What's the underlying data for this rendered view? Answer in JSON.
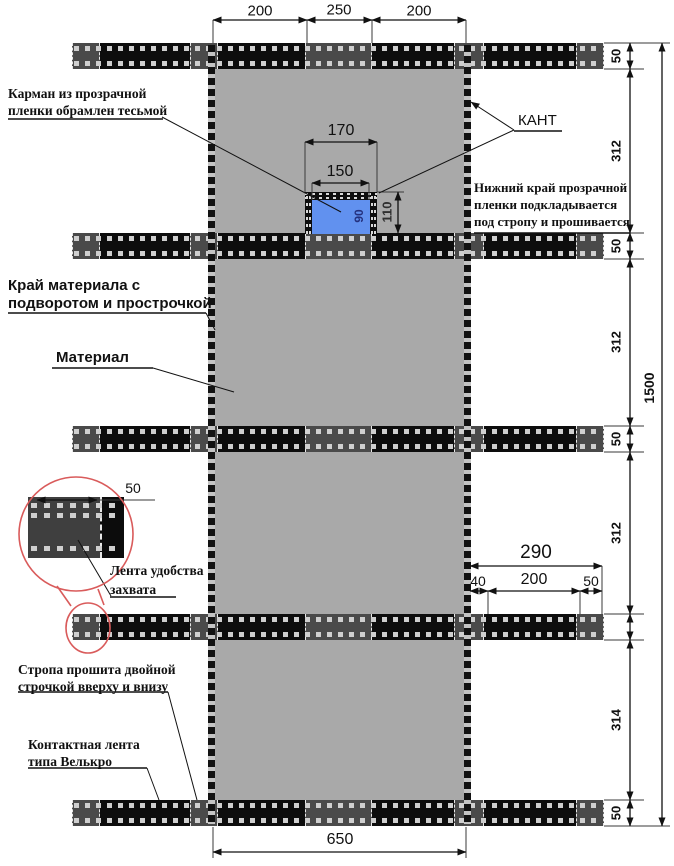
{
  "drawing": {
    "annotations": {
      "pocket": {
        "line1": "Карман из прозрачной",
        "line2": "пленки обрамлен тесьмой"
      },
      "kant": "КАНТ",
      "film_edge": {
        "line1": "Нижний край прозрачной",
        "line2": "пленки подкладывается",
        "line3": "под стропу и прошивается"
      },
      "material_edge": {
        "line1": "Край материала с",
        "line2": "подворотом и прострочкой"
      },
      "material": "Материал",
      "grip_tape": {
        "line1": "Лента удобства",
        "line2": "захвата"
      },
      "strap_stitching": {
        "line1": "Стропа прошита двойной",
        "line2": "строчкой вверху и внизу"
      },
      "velcro": {
        "line1": "Контактная лента",
        "line2": "типа Велькро"
      }
    },
    "dims": {
      "top": [
        "200",
        "250",
        "200"
      ],
      "pocket_outer_w": "170",
      "pocket_inner_w": "150",
      "pocket_h": "110",
      "pocket_film_h": "90",
      "right_chain": [
        "50",
        "312",
        "50",
        "312",
        "50",
        "312",
        "314",
        "50"
      ],
      "overall_h": "1500",
      "strap_right_total": "290",
      "strap_right_segments": [
        "40",
        "200",
        "50"
      ],
      "bottom_w": "650",
      "detail_grip_w": "50"
    },
    "colors": {
      "material": "#a9a9a9",
      "strap": "#0d0d0d",
      "strap_patch": "#4a4a4a",
      "pocket_film": "#6191ef",
      "highlight": "#d95b5b"
    }
  }
}
